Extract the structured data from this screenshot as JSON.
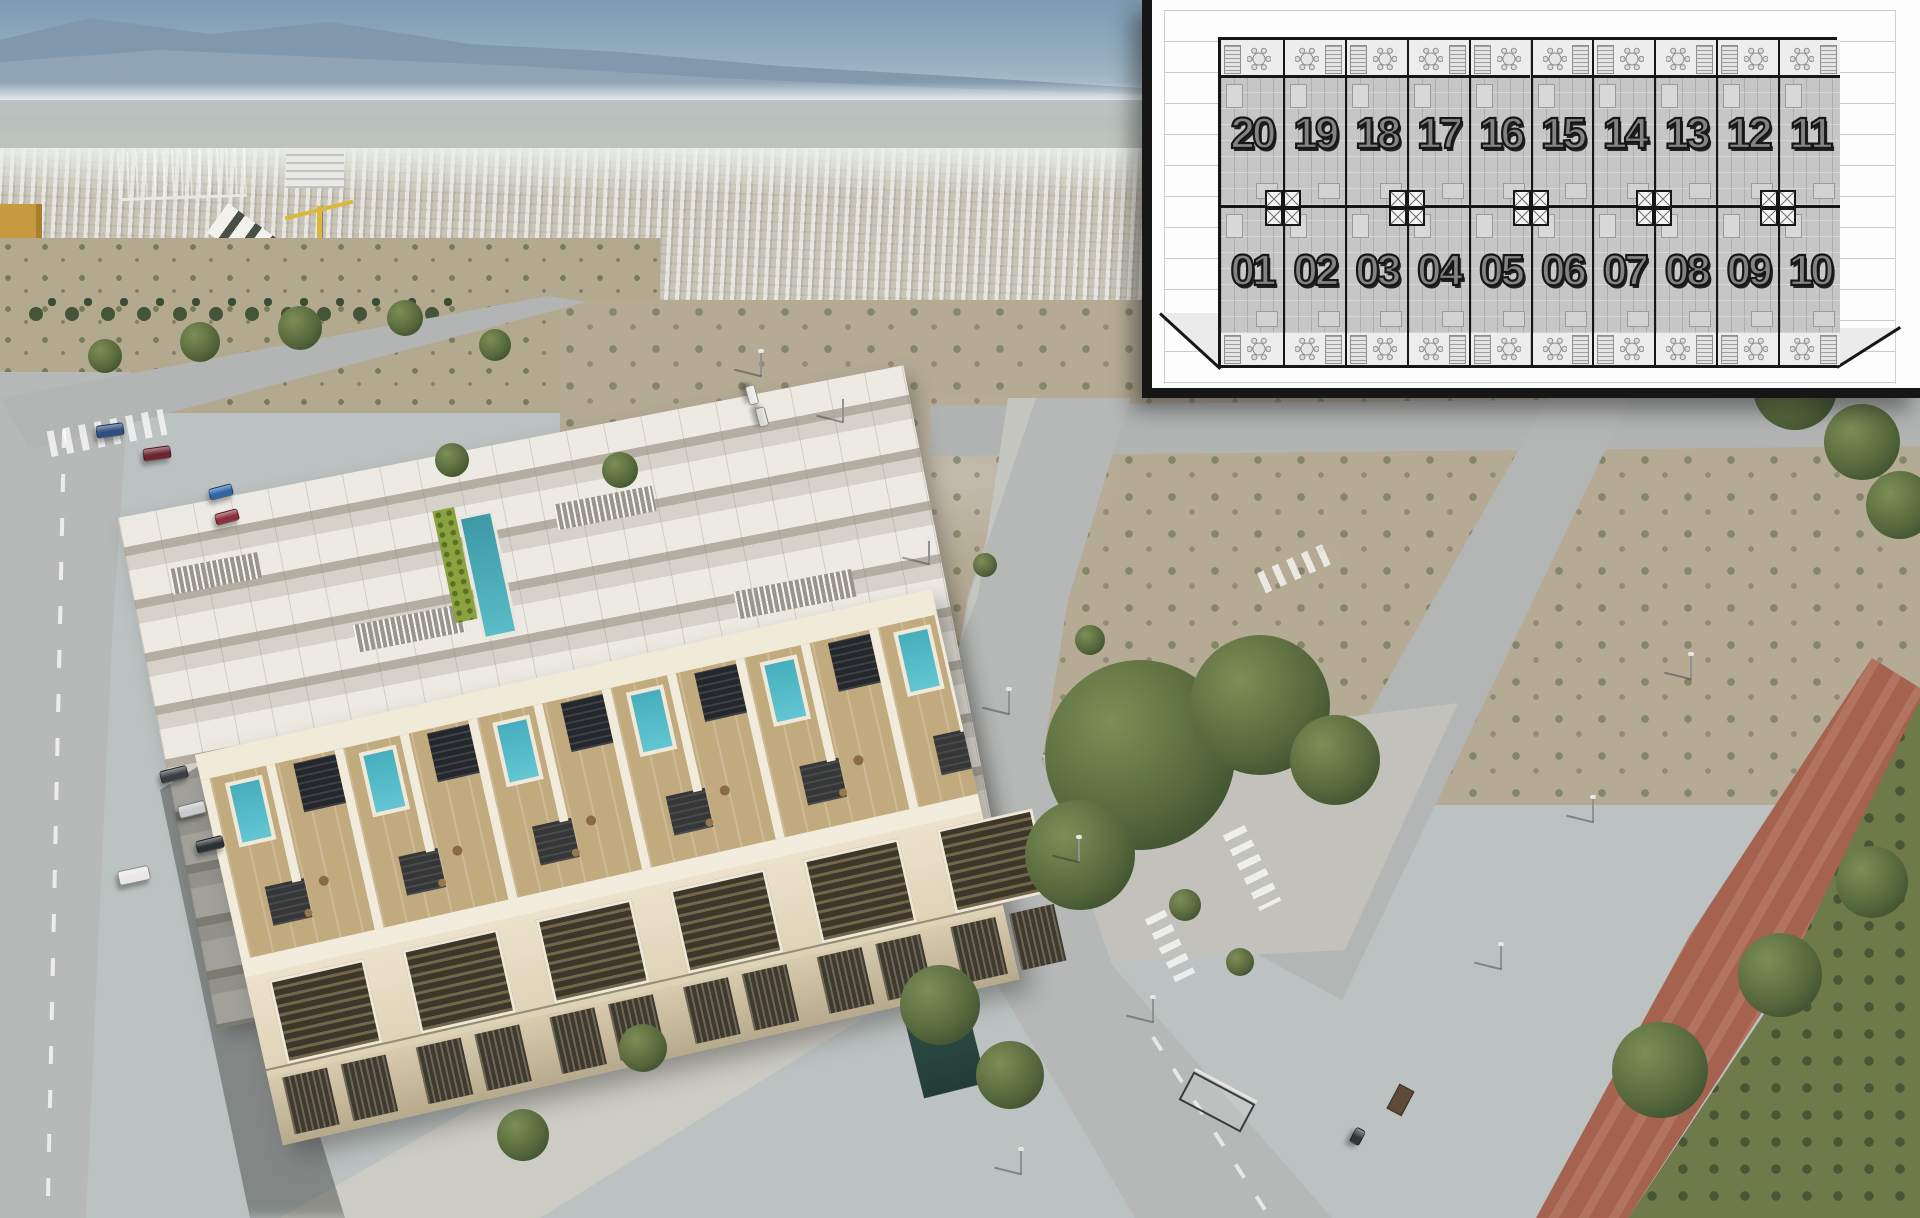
{
  "plan_inset": {
    "top_row": [
      "20",
      "19",
      "18",
      "17",
      "16",
      "15",
      "14",
      "13",
      "12",
      "11"
    ],
    "bottom_row": [
      "01",
      "02",
      "03",
      "04",
      "05",
      "06",
      "07",
      "08",
      "09",
      "10"
    ],
    "icons": {
      "round_table": "round-table-icon",
      "stairs": "stairs-hatch-icon",
      "core_shaft": "core-shaft-x-icon"
    },
    "colors": {
      "frame": "#161616",
      "paper": "#fdfdfd",
      "guide_lines": "#cbcbcb",
      "unit_body": "#c6c6c6",
      "terrace": "#ededed",
      "number_fill": "#838383",
      "number_outline": "#161616"
    }
  },
  "photo": {
    "colors": {
      "sky_top": "#7d9bb3",
      "sky_horizon": "#c2cdd3",
      "mountains": "#8197ab",
      "town": "#cbc8bc",
      "field": "#b3aa92",
      "road": "#b5b7b6",
      "red_path": "#a4624f",
      "green_strip": "#6f7a4b",
      "communal_pool": "#44a2b0",
      "private_pool": "#52b5c3",
      "building_cream": "#e9dfc8",
      "pergola_dark": "#26292c",
      "tree": "#4e6038",
      "crane_yellow": "#d8b93a"
    }
  }
}
